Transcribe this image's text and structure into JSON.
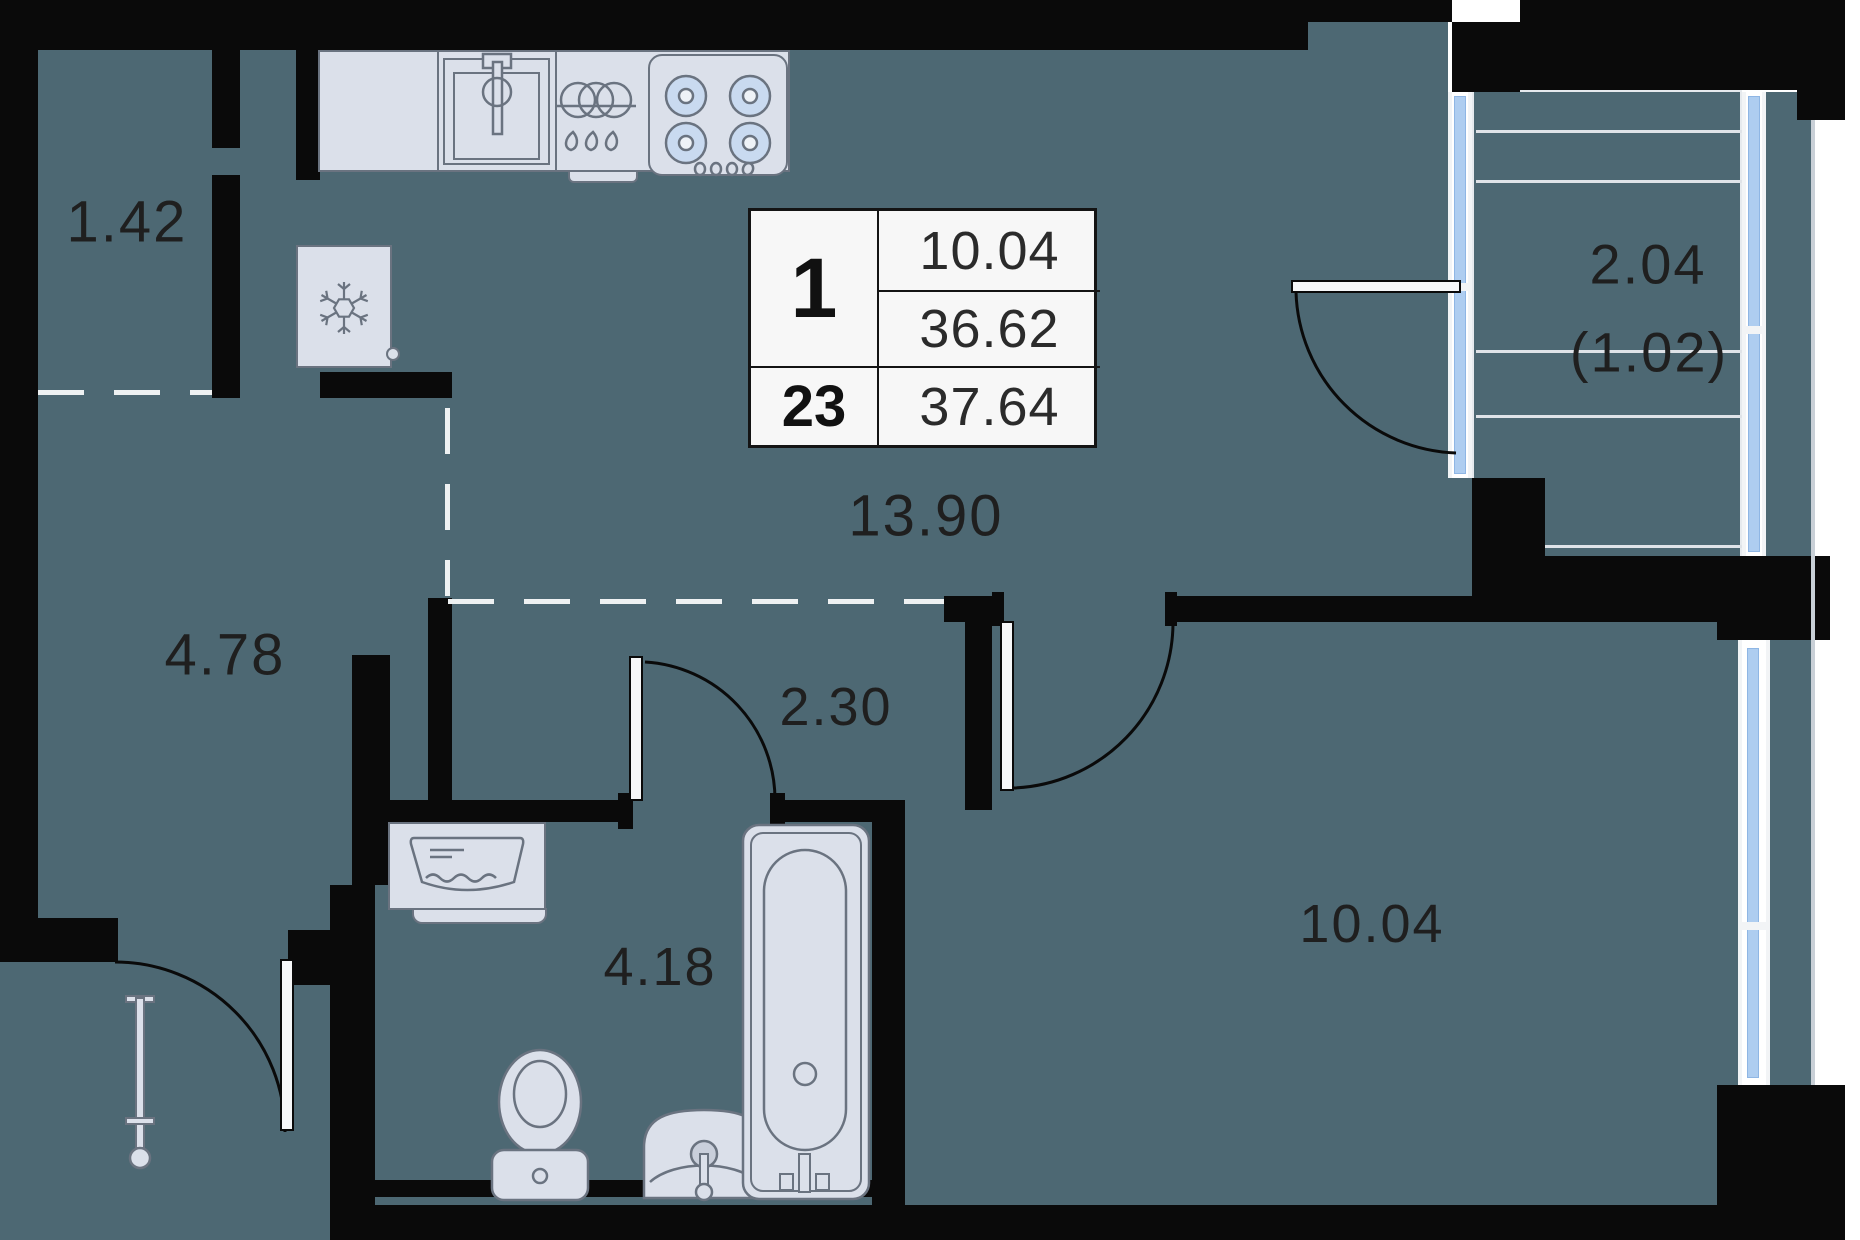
{
  "plan_title": "1-room apartment floor plan",
  "info_box": {
    "rooms_count": "1",
    "floor_number": "23",
    "living_area": "10.04",
    "area_without_balcony": "36.62",
    "total_area": "37.64"
  },
  "rooms": [
    {
      "name": "storage",
      "area": "1.42"
    },
    {
      "name": "hallway",
      "area": "4.78"
    },
    {
      "name": "kitchen-living",
      "area": "13.90"
    },
    {
      "name": "corridor",
      "area": "2.30"
    },
    {
      "name": "bathroom",
      "area": "4.18"
    },
    {
      "name": "bedroom",
      "area": "10.04"
    },
    {
      "name": "balcony",
      "area": "2.04",
      "area_note": "(1.02)"
    }
  ],
  "fixtures": [
    "kitchen-counter",
    "kitchen-sink",
    "dishwasher",
    "stove",
    "fridge",
    "washing-machine",
    "bathtub",
    "toilet",
    "washbasin",
    "radiator"
  ],
  "colors": {
    "floor": "#4d6873",
    "wall": "#0a0a0a",
    "fixture_fill": "#dbe0ea",
    "fixture_stroke": "#6a7380",
    "glazing": "#aecdf0",
    "label_text": "#1f1f1f",
    "info_box_bg": "#f7f7f7"
  }
}
